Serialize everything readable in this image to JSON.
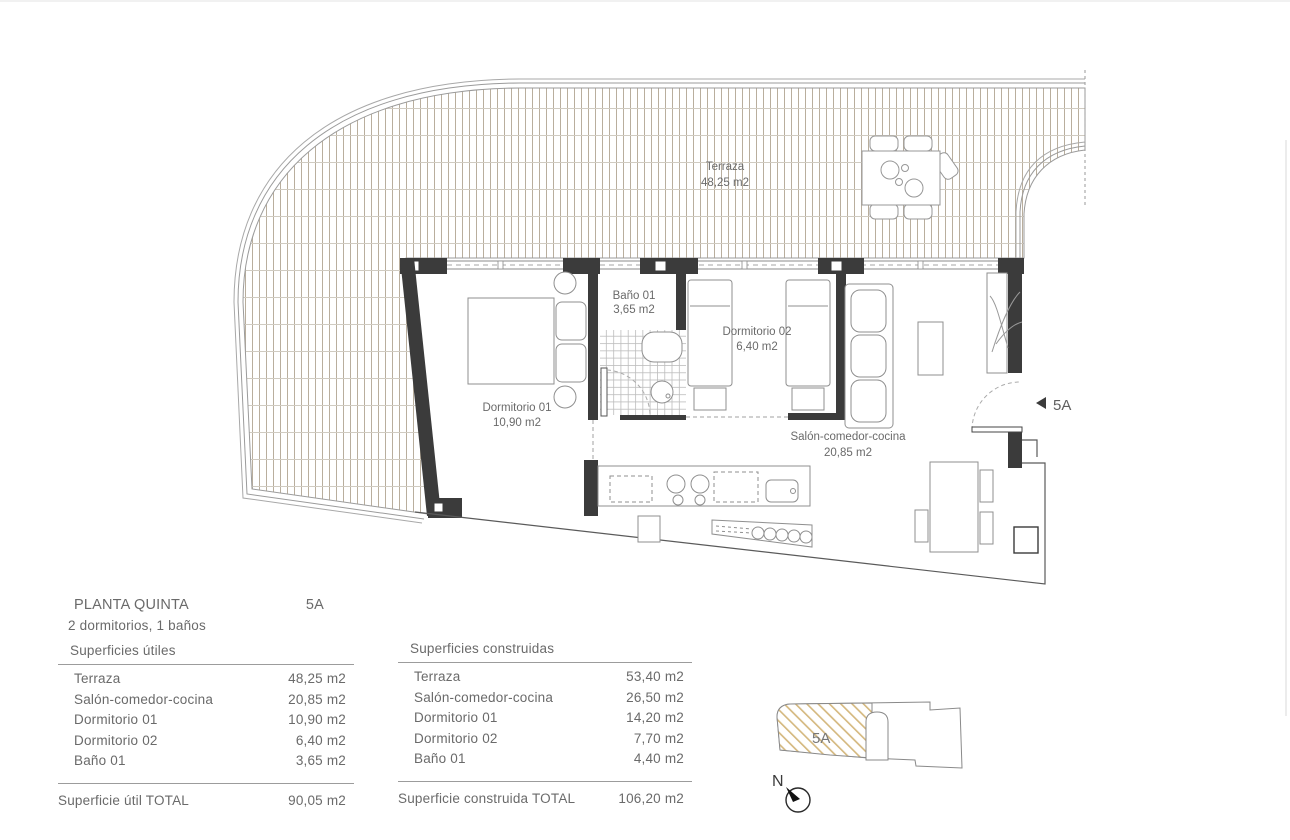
{
  "plan": {
    "floor_title": "PLANTA QUINTA",
    "unit": "5A",
    "subtitle": "2 dormitorios, 1 baños",
    "entrance_label": "5A",
    "rooms": {
      "terraza": {
        "name": "Terraza",
        "area": "48,25 m2"
      },
      "bano": {
        "name": "Baño 01",
        "area": "3,65 m2"
      },
      "dormitorio1": {
        "name": "Dormitorio 01",
        "area": "10,90 m2"
      },
      "dormitorio2": {
        "name": "Dormitorio 02",
        "area": "6,40 m2"
      },
      "salon": {
        "name": "Salón-comedor-cocina",
        "area": "20,85 m2"
      }
    }
  },
  "tables": {
    "utiles": {
      "title": "Superficies útiles",
      "rows": [
        {
          "label": "Terraza",
          "value": "48,25 m2"
        },
        {
          "label": "Salón-comedor-cocina",
          "value": "20,85 m2"
        },
        {
          "label": "Dormitorio 01",
          "value": "10,90 m2"
        },
        {
          "label": "Dormitorio 02",
          "value": "6,40 m2"
        },
        {
          "label": "Baño 01",
          "value": "3,65 m2"
        }
      ],
      "total_label": "Superficie útil TOTAL",
      "total_value": "90,05 m2"
    },
    "construidas": {
      "title": "Superficies construidas",
      "rows": [
        {
          "label": "Terraza",
          "value": "53,40 m2"
        },
        {
          "label": "Salón-comedor-cocina",
          "value": "26,50 m2"
        },
        {
          "label": "Dormitorio 01",
          "value": "14,20 m2"
        },
        {
          "label": "Dormitorio 02",
          "value": "7,70 m2"
        },
        {
          "label": "Baño 01",
          "value": "4,40 m2"
        }
      ],
      "total_label": "Superficie construida TOTAL",
      "total_value": "106,20 m2"
    }
  },
  "key": {
    "unit_label": "5A",
    "north_label": "N"
  },
  "colors": {
    "wall": "#3b3b3b",
    "furniture_line": "#8f8f8f",
    "deck_line": "#b9ae9d",
    "hatch": "#d4b87e",
    "text": "#6a6a6a"
  }
}
